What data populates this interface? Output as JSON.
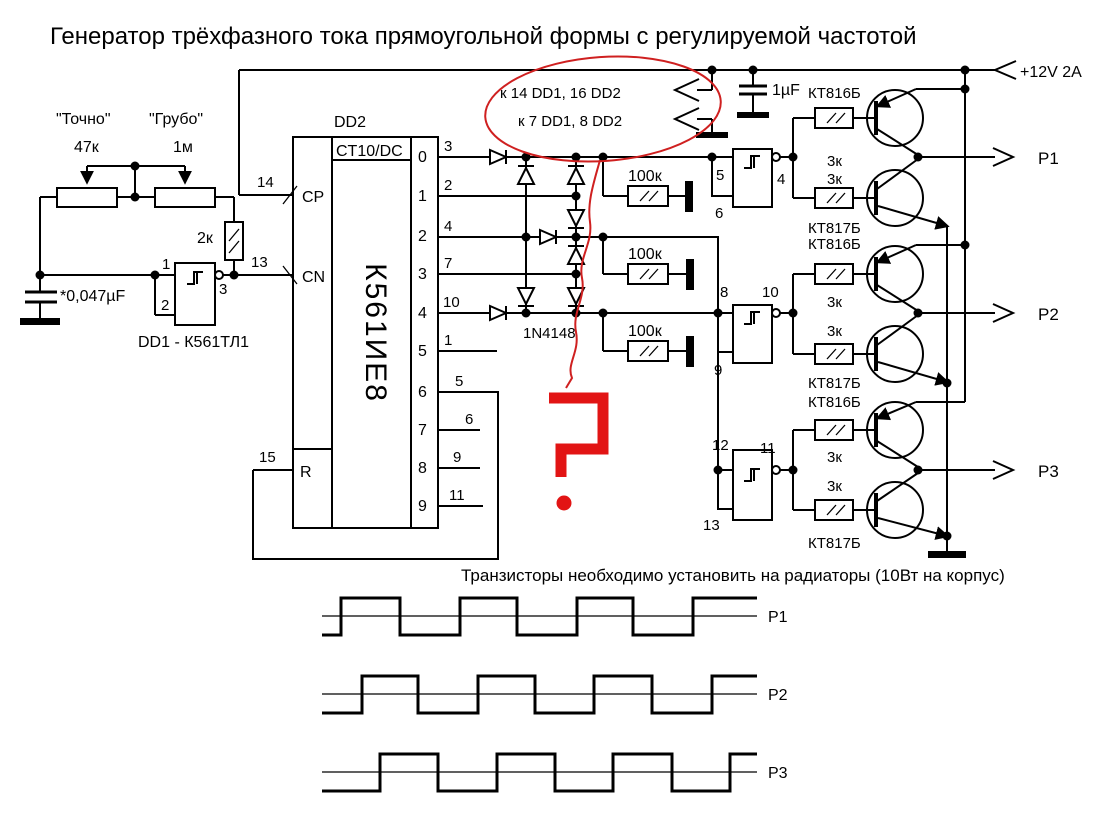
{
  "title": "Генератор трёхфазного тока прямоугольной формы с регулируемой частотой",
  "note": "Транзисторы необходимо установить на радиаторы (10Вт на корпус)",
  "power": {
    "label": "+12V 2A",
    "cap": "1µF",
    "note1": "к 14 DD1, 16 DD2",
    "note2": "к 7 DD1, 8 DD2"
  },
  "osc": {
    "fine_name": "\"Точно\"",
    "fine_val": "47к",
    "coarse_name": "\"Грубо\"",
    "coarse_val": "1м",
    "r2k": "2к",
    "cap": "*0,047µF",
    "dd1": "DD1 - К561ТЛ1",
    "pin1": "1",
    "pin2": "2",
    "pin3": "3"
  },
  "dd2": {
    "name": "DD2",
    "part": "К561ИЕ8",
    "func": "CT10/DC",
    "cp": "CP",
    "cn": "CN",
    "r": "R",
    "cp_pin": "14",
    "cn_pin": "13",
    "r_pin": "15",
    "outs": [
      {
        "q": "0",
        "pin": "3"
      },
      {
        "q": "1",
        "pin": "2"
      },
      {
        "q": "2",
        "pin": "4"
      },
      {
        "q": "3",
        "pin": "7"
      },
      {
        "q": "4",
        "pin": "10"
      },
      {
        "q": "5",
        "pin": "1"
      },
      {
        "q": "6",
        "pin": "5"
      },
      {
        "q": "7",
        "pin": "6"
      },
      {
        "q": "8",
        "pin": "9"
      },
      {
        "q": "9",
        "pin": "11"
      }
    ]
  },
  "matrix": {
    "diode": "1N4148",
    "r1": "100к",
    "r2": "100к",
    "r3": "100к"
  },
  "buf": [
    {
      "a": "5",
      "b": "6",
      "out": "4"
    },
    {
      "a": "8",
      "b": "9",
      "out": "10"
    },
    {
      "a": "12",
      "b": "13",
      "out": "11"
    }
  ],
  "stage": {
    "r3k": "3к",
    "pnp": "КТ816Б",
    "npn": "КТ817Б"
  },
  "out": {
    "p1": "P1",
    "p2": "P2",
    "p3": "P3"
  }
}
